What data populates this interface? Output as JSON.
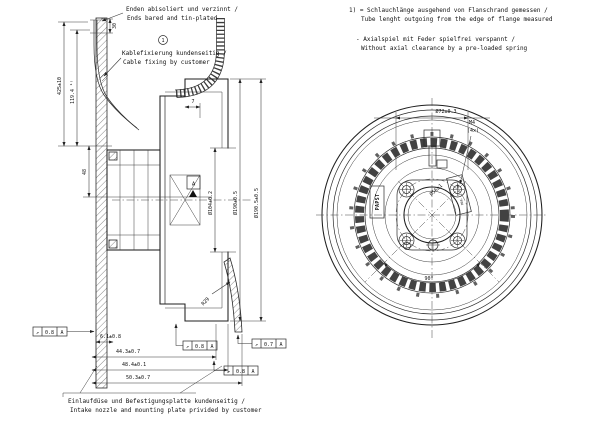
{
  "notes": {
    "ref": "1",
    "tl1_de": "Enden abisoliert und verzinnt /",
    "tl1_en": "Ends bared and tin-plated",
    "tl2_de": "Kablefixierung kundenseitig /",
    "tl2_en": "Cable fixing by customer",
    "tr1_de": "1) = Schlauchlänge ausgehend von Flanschrand gemessen /",
    "tr1_en": "Tube lenght outgoing from the edge of flange measured",
    "tr2_de": "- Axialspiel mit Feder spielfrei verspannt /",
    "tr2_en": "Without axial clearance by a pre-loaded spring",
    "bottom_de": "Einlaufdüse und Befestigungsplatte kundenseitig /",
    "bottom_en": "Intake nozzle and mounting plate privided by customer"
  },
  "sv": {
    "d30": "30",
    "d425": "425±10",
    "d119": "119.4 ¹⁾",
    "d48": "48",
    "d7": "7",
    "d104": "Ø104±0.2",
    "d190": "Ø190±0.5",
    "d1905": "Ø190.5±0.5",
    "r29": "R29",
    "d61": "6.1±0.8",
    "d443": "44.3±0.7",
    "d484": "48.4±0.1",
    "d503": "50.3±0.7",
    "datum": "A"
  },
  "fv": {
    "d72": "Ø72±0.3",
    "m4": "M4",
    "m4count": "(4x)",
    "d56": "Ø56±1",
    "a90": "90°",
    "logo": "PAPST",
    "nameplate": "MAX. 7.5 Nm"
  },
  "frames": [
    {
      "sym": "↗",
      "value": "0.8",
      "datum": "A"
    },
    {
      "sym": "↗",
      "value": "0.8",
      "datum": "A"
    },
    {
      "sym": "↗",
      "value": "0.8",
      "datum": "A"
    },
    {
      "sym": "↗",
      "value": "0.7",
      "datum": "A"
    }
  ],
  "colors": {
    "line": "#1f1f1f",
    "background": "#ffffff"
  }
}
